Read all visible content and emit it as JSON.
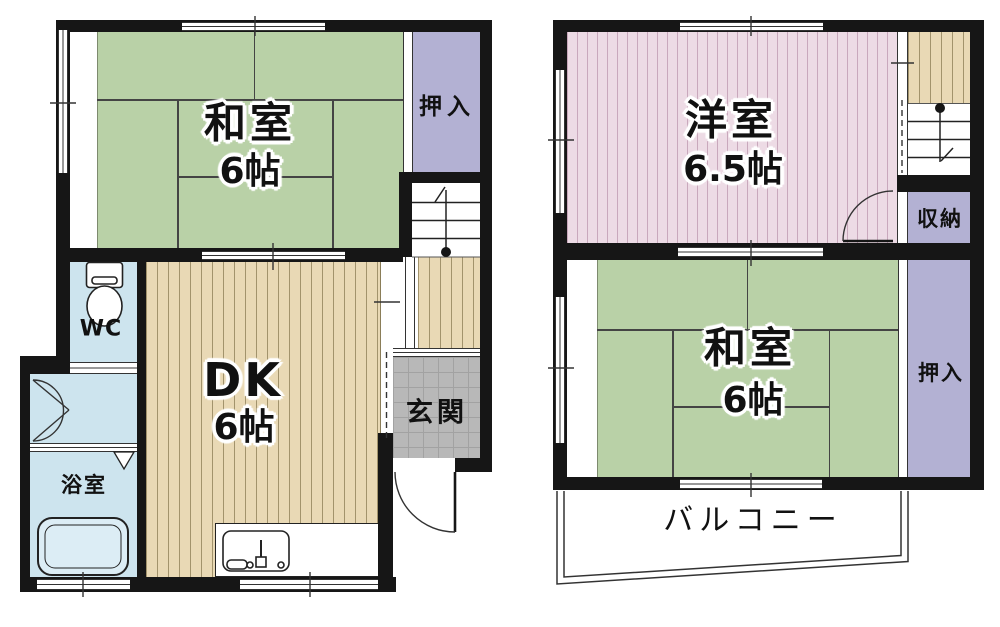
{
  "colors": {
    "wall": "#161616",
    "tatami": "#b9d1a7",
    "tatami_line": "#444444",
    "closet": "#b3b1d3",
    "western": "#eddbe5",
    "western_stripe": "#c9a8bc",
    "wood": "#e9d9b5",
    "wood_line": "#a2936c",
    "water": "#cde4ee",
    "tub": "#dcedf5",
    "tile": "#b8b8b8",
    "tile_line": "#a2a2a2"
  },
  "floor1": {
    "rooms": {
      "washitsu": {
        "label": "和室",
        "size": "6帖"
      },
      "oshiire": {
        "label": "押入"
      },
      "wc": {
        "label": "WC"
      },
      "bathroom": {
        "label": "浴室"
      },
      "dk": {
        "label": "DK",
        "size": "6帖"
      },
      "genkan": {
        "label": "玄関"
      }
    }
  },
  "floor2": {
    "rooms": {
      "yoshitsu": {
        "label": "洋室",
        "size": "6.5帖"
      },
      "shunou": {
        "label": "収納"
      },
      "washitsu": {
        "label": "和室",
        "size": "6帖"
      },
      "oshiire": {
        "label": "押入"
      },
      "balcony": {
        "label": "バルコニー"
      }
    }
  },
  "icons": {
    "toilet": "toilet-icon",
    "bathtub": "bathtub-icon",
    "kitchen_sink": "kitchen-sink-icon",
    "stairs_up": "stairs-up-icon",
    "stairs_down": "stairs-down-icon",
    "door_swing": "door-swing-icon",
    "balcony_outline": "balcony-outline"
  }
}
